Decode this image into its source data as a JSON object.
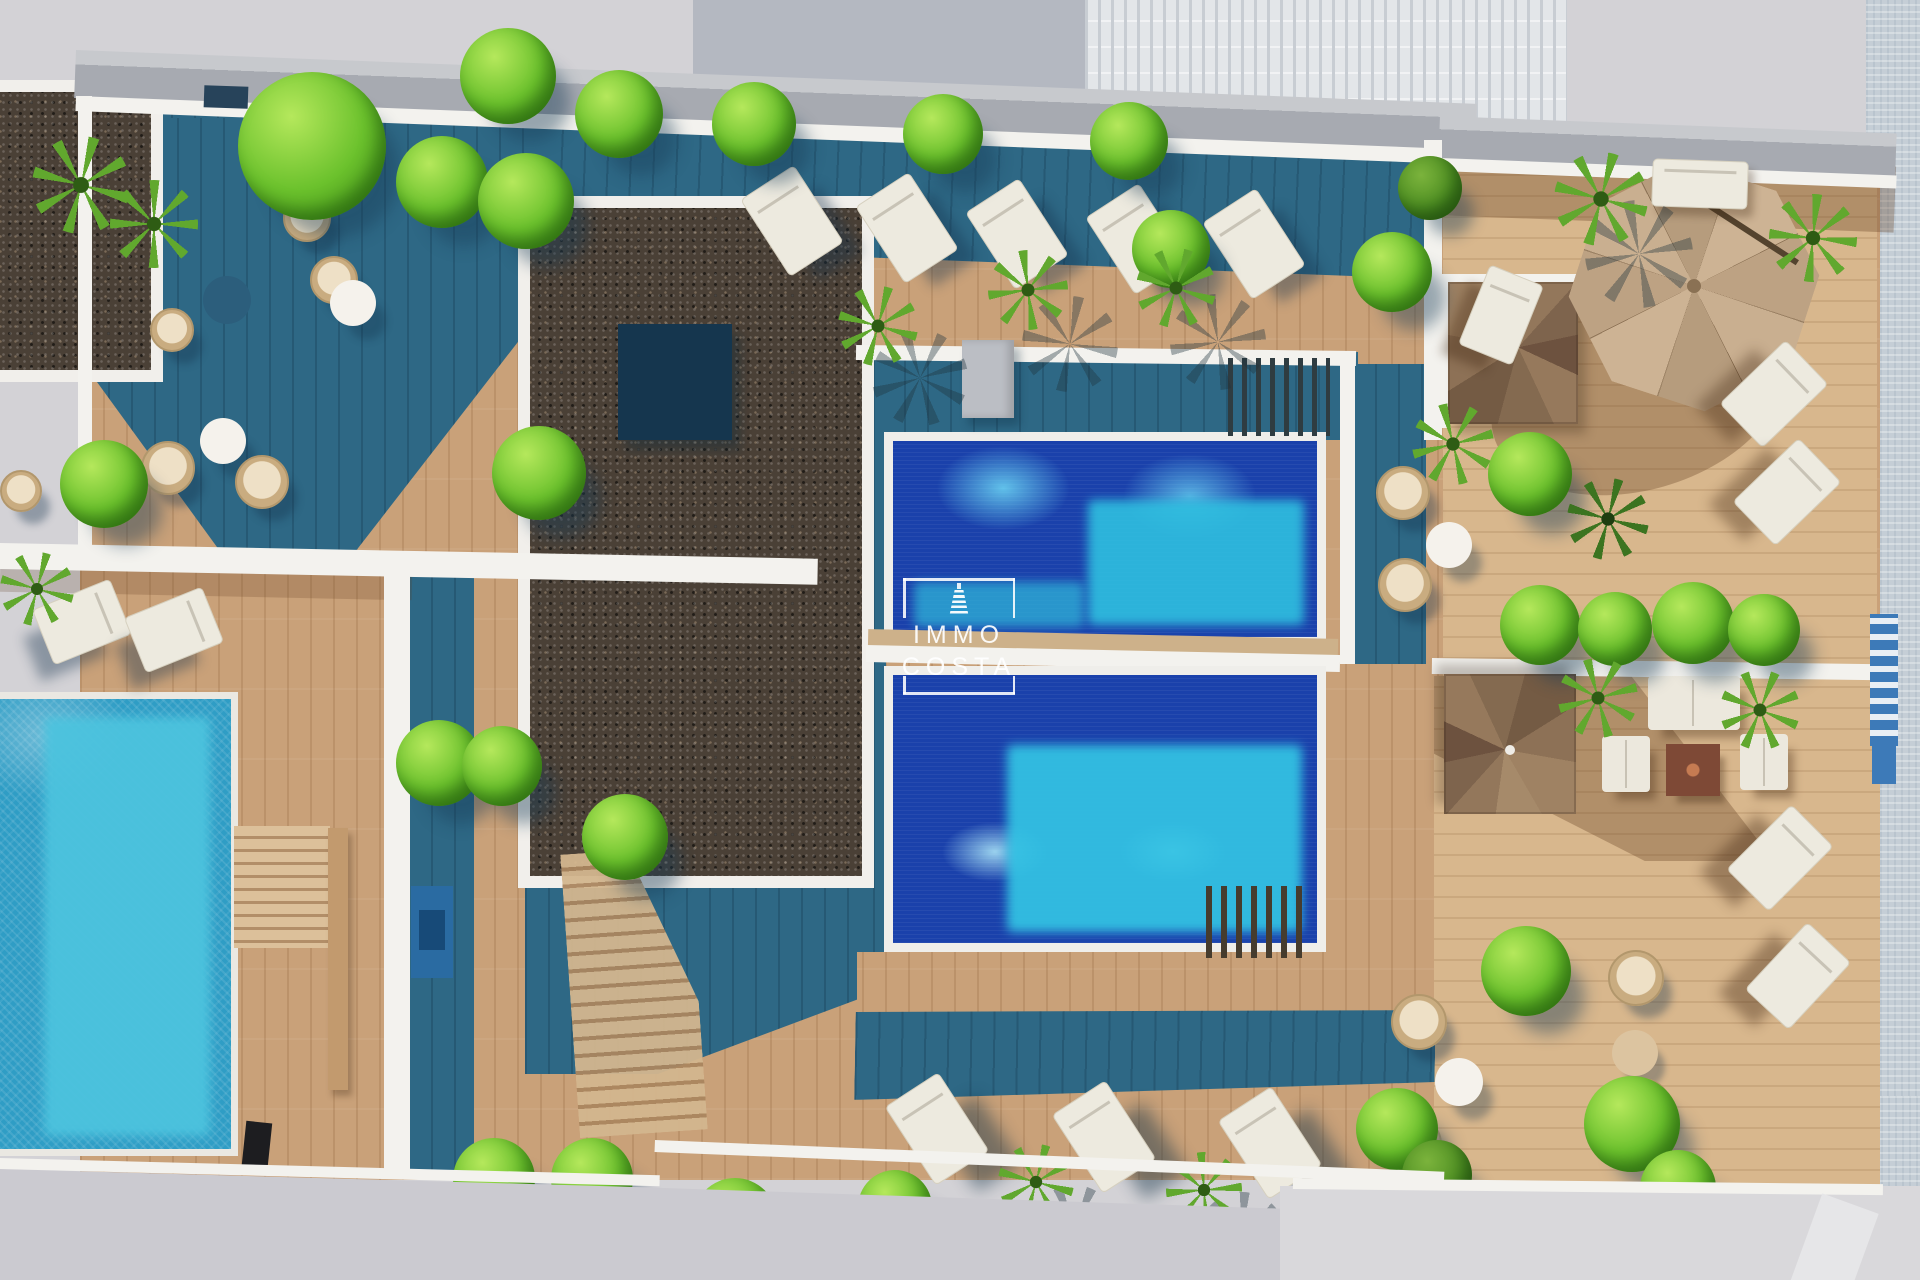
{
  "meta": {
    "image_type": "aerial-architectural-3d-render",
    "subject": "rooftop terrace of a residential building with two community pools, wooden sun decks, loungers, plants and a private pool on a lower terrace"
  },
  "watermark": {
    "brand_line1": "IMMO",
    "brand_line2": "COSTA",
    "icon": "lighthouse-tower-icon"
  },
  "palette": {
    "background_gray": "#d3d2d6",
    "neighbor_building": "#b4b8c1",
    "ribbed_facade": "#e3e6e9",
    "street_pavement": "#c5ced6",
    "parapet_gray": "#a7aab1",
    "wall_white": "#f3f2ee",
    "deck_sunlit": "#c9a179",
    "deck_light": "#d8b78d",
    "deck_shadow_teal": "#2e6885",
    "gravel_dark": "#4a4036",
    "pool_deep_blue": "#1a41ab",
    "pool_turquoise": "#33c4e4",
    "left_pool_blue": "#2f9dc5",
    "left_pool_inner": "#4cc3de",
    "bush_green": "#6cc22d",
    "palm_green": "#61a82e",
    "lounger_white": "#edeadf",
    "umbrella_tan": "#c5ab8c",
    "wicker_tan": "#c9ac80",
    "stair_wood": "#93775b"
  },
  "scene_elements": [
    "upper-community-pool",
    "lower-community-pool",
    "private-pool",
    "gravel-roof-patch",
    "sun-lounger",
    "parasol-umbrella",
    "spiral-staircase",
    "wicker-chair",
    "round-table",
    "outdoor-sofa-set",
    "wood-deck",
    "teal-shadow",
    "bush",
    "palm-plant",
    "street",
    "railing"
  ]
}
